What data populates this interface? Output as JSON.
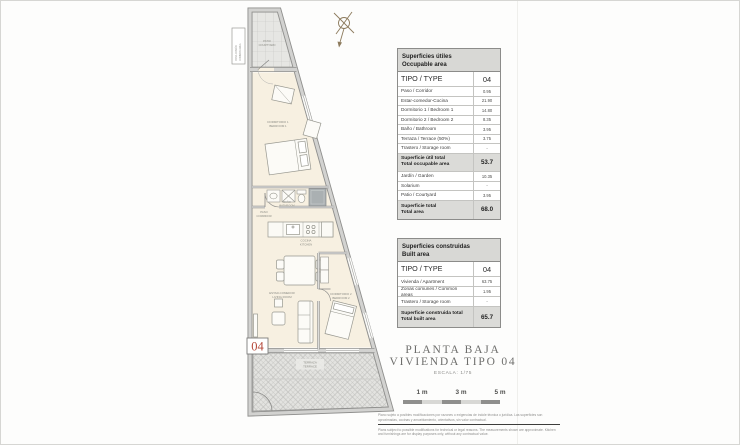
{
  "plan": {
    "unit_number": "04",
    "rooms": {
      "patio": {
        "l1": "PATIO",
        "l2": "COURTYARD"
      },
      "side": {
        "l1": "ZONA COMÚN",
        "l2": "COMMON AREA"
      },
      "bedroom1": {
        "l1": "DORMITORIO 1",
        "l2": "BEDROOM 1"
      },
      "bathroom": {
        "l1": "BAÑO",
        "l2": "BATHROOM"
      },
      "corridor": {
        "l1": "PASO",
        "l2": "CORRIDOR"
      },
      "kitchen": {
        "l1": "COCINA",
        "l2": "KITCHEN"
      },
      "living": {
        "l1": "ESTAR-COMEDOR",
        "l2": "LIVING ROOM"
      },
      "bedroom2": {
        "l1": "DORMITORIO 2",
        "l2": "BEDROOM 2"
      },
      "terrace": {
        "l1": "TERRAZA",
        "l2": "TERRACE"
      }
    }
  },
  "tables": {
    "occupable": {
      "title_es": "Superficies útiles",
      "title_en": "Occupable area",
      "type_label": "TIPO / TYPE",
      "type_value": "04",
      "rows": [
        {
          "label": "Paso / Corridor",
          "value": "0.95"
        },
        {
          "label": "Estar-comedor-Cocina",
          "value": "21.90"
        },
        {
          "label": "Dormitorio 1 / Bedroom 1",
          "value": "14.80"
        },
        {
          "label": "Dormitorio 2 / Bedroom 2",
          "value": "8.35"
        },
        {
          "label": "Baño / Bathroom",
          "value": "3.95"
        },
        {
          "label": "Terraza / Terrace (50%)",
          "value": "3.75"
        },
        {
          "label": "Trastero / Storage room",
          "value": "-"
        },
        {
          "label": "Superficie útil total",
          "label2": "Total occupable area",
          "value": "53.7"
        },
        {
          "label": "Jardín / Garden",
          "value": "10.35"
        },
        {
          "label": "Solarium",
          "value": "-"
        },
        {
          "label": "Patio / Courtyard",
          "value": "3.95"
        },
        {
          "label": "Superficie total",
          "label2": "Total area",
          "value": "68.0"
        }
      ]
    },
    "built": {
      "title_es": "Superficies construidas",
      "title_en": "Built area",
      "type_label": "TIPO / TYPE",
      "type_value": "04",
      "rows": [
        {
          "label": "Vivienda / Apartment",
          "value": "63.75"
        },
        {
          "label": "Zonas comunes / Common areas",
          "value": "1.95"
        },
        {
          "label": "Trastero / Storage room",
          "value": "-"
        },
        {
          "label": "Superficie construida total",
          "label2": "Total built area",
          "value": "65.7"
        }
      ]
    }
  },
  "titleblock": {
    "line1": "PLANTA BAJA",
    "line2": "VIVIENDA TIPO 04",
    "scale_note": "ESCALA: 1/75"
  },
  "scalebar": {
    "labels": [
      "1 m",
      "3 m",
      "5 m"
    ]
  },
  "disclaimer": {
    "es": "Plano sujeto a posibles modificaciones por razones o exigencias de índole técnica o jurídica. Las superficies son aproximadas, cocinas y amueblamiento, orientativos, sin valor contractual.",
    "en": "Plans subject to possible modifications for technical or legal reasons. The measurements shown are approximate. Kitchen and furnishings are for display purposes only, without any contractual value."
  },
  "colors": {
    "accent_red": "#b5493a",
    "table_header_bg": "#d8d8d5",
    "total_row_bg": "#dbdbd8",
    "interior_floor": "#f7f0e1"
  }
}
